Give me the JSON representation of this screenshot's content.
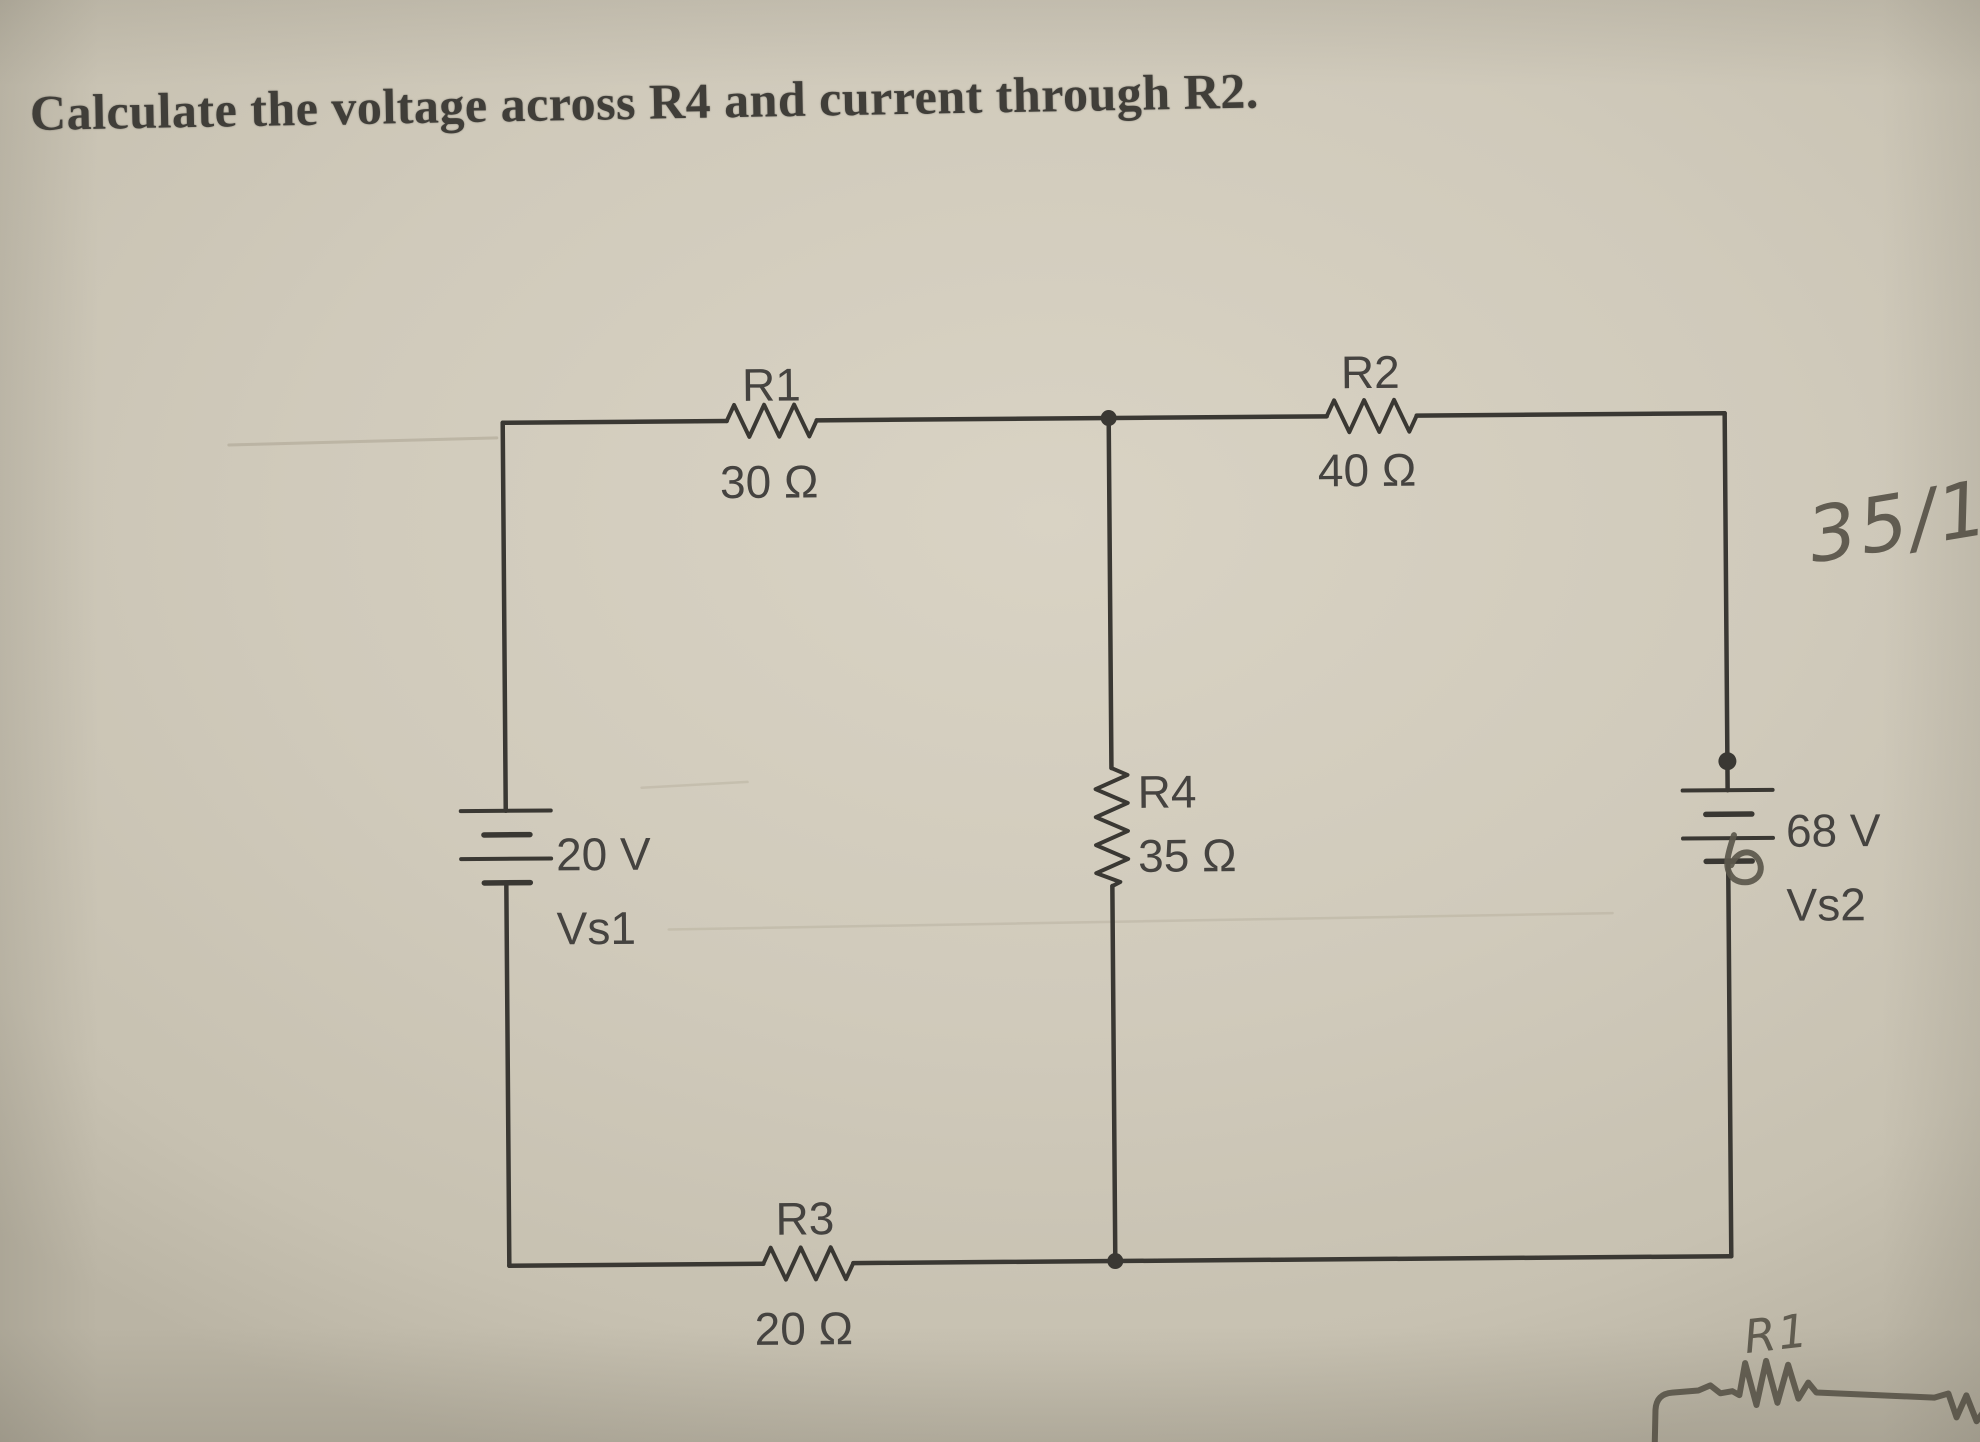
{
  "title": "Calculate the voltage across R4 and current through R2.",
  "circuit": {
    "r1": {
      "name": "R1",
      "value": "30 Ω"
    },
    "r2": {
      "name": "R2",
      "value": "40 Ω"
    },
    "r3": {
      "name": "R3",
      "value": "20 Ω"
    },
    "r4": {
      "name": "R4",
      "value": "35 Ω"
    },
    "vs1": {
      "name": "Vs1",
      "value": "20 V"
    },
    "vs2": {
      "name": "Vs2",
      "value": "68 V"
    }
  },
  "handwriting": {
    "grade": "35/14",
    "sketch_label": "R1"
  },
  "colors": {
    "paper": "#d0cabb",
    "ink": "#3a3833",
    "pencil": "#5b574b"
  }
}
